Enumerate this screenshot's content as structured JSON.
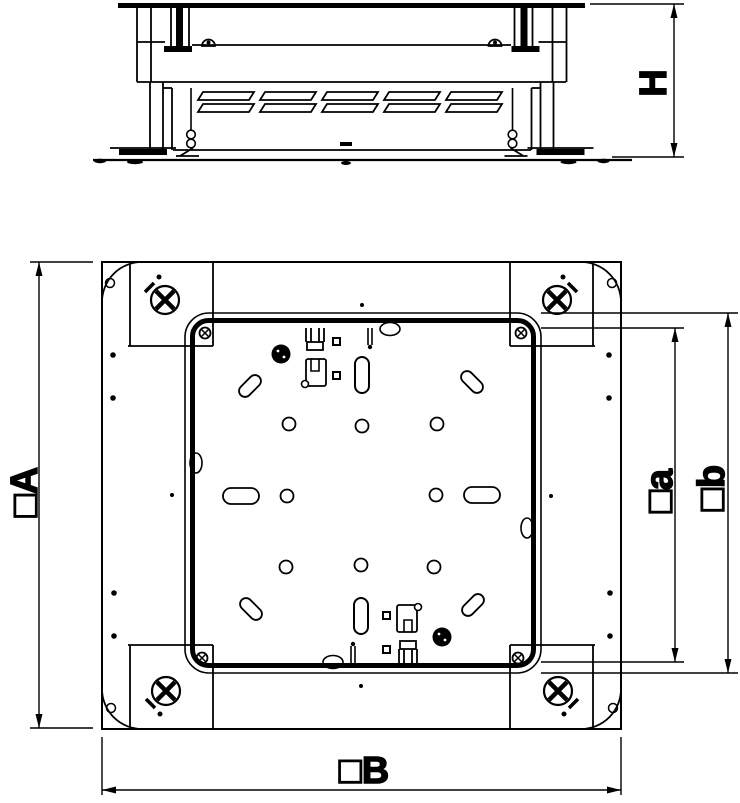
{
  "drawing": {
    "background_color": "#ffffff",
    "line_color": "#000000",
    "labels": {
      "height": "H",
      "outer_square": "□A",
      "bottom_width": "□B",
      "inner_square_a": "□a",
      "inner_square_b": "□b"
    }
  }
}
